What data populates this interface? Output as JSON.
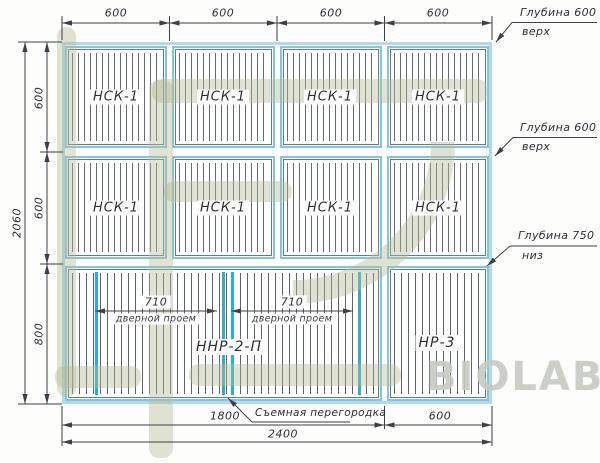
{
  "watermark": {
    "text": "BIOLAB"
  },
  "dimensions": {
    "top": [
      "600",
      "600",
      "600",
      "600"
    ],
    "left_overall": "2060",
    "left_rows": [
      "600",
      "600",
      "800"
    ],
    "bottom_left": "1800",
    "bottom_overall": "2400",
    "bottom_right": "600"
  },
  "panels": {
    "row1": [
      "НСК-1",
      "НСК-1",
      "НСК-1",
      "НСК-1"
    ],
    "row2": [
      "НСК-1",
      "НСК-1",
      "НСК-1",
      "НСК-1"
    ],
    "row3_left": "ННР-2-П",
    "row3_right": "НР-3"
  },
  "door_openings": [
    {
      "width": "710",
      "caption": "дверной проем"
    },
    {
      "width": "710",
      "caption": "дверной проем"
    }
  ],
  "callouts": {
    "depth_top_1": {
      "line1": "Глубина 600",
      "line2": "верх"
    },
    "depth_top_2": {
      "line1": "Глубина 600",
      "line2": "верх"
    },
    "depth_bottom": {
      "line1": "Глубина 750",
      "line2": "низ"
    },
    "partition": "Съемная перегородка"
  },
  "colors": {
    "outer_wall": "#b2dae8",
    "panel_frame": "#87c4d9",
    "panel_frame_inner": "#54809b",
    "partition": "#2fadd0",
    "dimension_lines": "#3f3f49",
    "watermark_olive": "#b5bb96",
    "watermark_gray": "#c7cac3"
  }
}
